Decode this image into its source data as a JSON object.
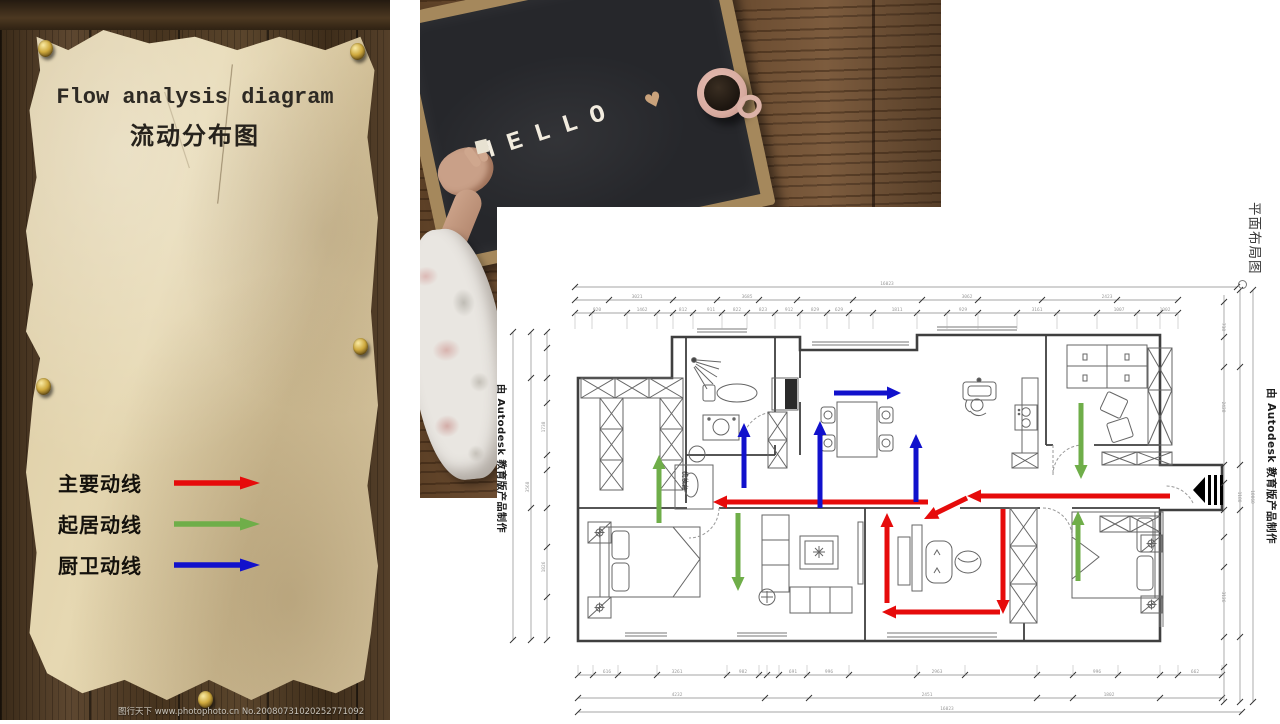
{
  "left_panel": {
    "title_en": "Flow analysis diagram",
    "title_zh": "流动分布图",
    "legend": [
      {
        "label": "主要动线",
        "color": "#e60b0b"
      },
      {
        "label": "起居动线",
        "color": "#6fae49"
      },
      {
        "label": "厨卫动线",
        "color": "#1111cc"
      }
    ],
    "watermark": "图行天下 www.photophoto.cn  No.20080731020252771092"
  },
  "photo": {
    "board_word": "HELLO",
    "heart": "♥"
  },
  "floor_plan": {
    "side_label": "平面布局图",
    "cad_watermark": "由 Autodesk 教育版产品制作",
    "vanity_label": "梳妆台",
    "arrow_colors": {
      "main": "#e60b0b",
      "living": "#6fae49",
      "kitchen_bath": "#1111cc"
    },
    "arrows": [
      {
        "type": "main",
        "x1": 673,
        "y1": 289,
        "x2": 470,
        "y2": 289
      },
      {
        "type": "main",
        "x1": 431,
        "y1": 295,
        "x2": 216,
        "y2": 295
      },
      {
        "type": "main",
        "x1": 470,
        "y1": 291,
        "x2": 427,
        "y2": 312
      },
      {
        "type": "main",
        "x1": 390,
        "y1": 396,
        "x2": 390,
        "y2": 306
      },
      {
        "type": "main",
        "x1": 506,
        "y1": 302,
        "x2": 506,
        "y2": 407
      },
      {
        "type": "main",
        "x1": 503,
        "y1": 405,
        "x2": 385,
        "y2": 405
      },
      {
        "type": "living",
        "x1": 162,
        "y1": 316,
        "x2": 162,
        "y2": 248
      },
      {
        "type": "living",
        "x1": 241,
        "y1": 306,
        "x2": 241,
        "y2": 384
      },
      {
        "type": "living",
        "x1": 584,
        "y1": 196,
        "x2": 584,
        "y2": 272
      },
      {
        "type": "living",
        "x1": 581,
        "y1": 374,
        "x2": 581,
        "y2": 304
      },
      {
        "type": "kitchen_bath",
        "x1": 247,
        "y1": 281,
        "x2": 247,
        "y2": 216
      },
      {
        "type": "kitchen_bath",
        "x1": 323,
        "y1": 301,
        "x2": 323,
        "y2": 214
      },
      {
        "type": "kitchen_bath",
        "x1": 337,
        "y1": 186,
        "x2": 404,
        "y2": 186
      },
      {
        "type": "kitchen_bath",
        "x1": 419,
        "y1": 295,
        "x2": 419,
        "y2": 227
      }
    ],
    "dim_labels": {
      "top": [
        {
          "x": 390,
          "y": 78,
          "t": "16023"
        },
        {
          "x": 140,
          "y": 91,
          "t": "3021"
        },
        {
          "x": 250,
          "y": 91,
          "t": "3685"
        },
        {
          "x": 470,
          "y": 91,
          "t": "3062"
        },
        {
          "x": 610,
          "y": 91,
          "t": "2423"
        },
        {
          "x": 100,
          "y": 104,
          "t": "920"
        },
        {
          "x": 145,
          "y": 104,
          "t": "1462"
        },
        {
          "x": 186,
          "y": 104,
          "t": "812"
        },
        {
          "x": 214,
          "y": 104,
          "t": "911"
        },
        {
          "x": 240,
          "y": 104,
          "t": "822"
        },
        {
          "x": 266,
          "y": 104,
          "t": "823"
        },
        {
          "x": 292,
          "y": 104,
          "t": "912"
        },
        {
          "x": 318,
          "y": 104,
          "t": "829"
        },
        {
          "x": 342,
          "y": 104,
          "t": "629"
        },
        {
          "x": 400,
          "y": 104,
          "t": "1811"
        },
        {
          "x": 466,
          "y": 104,
          "t": "929"
        },
        {
          "x": 540,
          "y": 104,
          "t": "3161"
        },
        {
          "x": 622,
          "y": 104,
          "t": "1007"
        },
        {
          "x": 668,
          "y": 104,
          "t": "1002"
        }
      ],
      "bottom": [
        {
          "x": 110,
          "y": 466,
          "t": "616"
        },
        {
          "x": 180,
          "y": 466,
          "t": "3261"
        },
        {
          "x": 246,
          "y": 466,
          "t": "982"
        },
        {
          "x": 296,
          "y": 466,
          "t": "691"
        },
        {
          "x": 332,
          "y": 466,
          "t": "996"
        },
        {
          "x": 440,
          "y": 466,
          "t": "2963"
        },
        {
          "x": 600,
          "y": 466,
          "t": "996"
        },
        {
          "x": 698,
          "y": 466,
          "t": "662"
        },
        {
          "x": 180,
          "y": 489,
          "t": "4232"
        },
        {
          "x": 430,
          "y": 489,
          "t": "2451"
        },
        {
          "x": 612,
          "y": 489,
          "t": "1802"
        },
        {
          "x": 450,
          "y": 503,
          "t": "16023"
        }
      ],
      "left": [
        {
          "x": 48,
          "y": 220,
          "t": "1738",
          "rot": -90
        },
        {
          "x": 48,
          "y": 360,
          "t": "1826",
          "rot": -90
        },
        {
          "x": 32,
          "y": 280,
          "t": "3568",
          "rot": -90
        }
      ],
      "right": [
        {
          "x": 725,
          "y": 120,
          "t": "738",
          "rot": 90
        },
        {
          "x": 725,
          "y": 200,
          "t": "2428",
          "rot": 90
        },
        {
          "x": 725,
          "y": 390,
          "t": "3126",
          "rot": 90
        },
        {
          "x": 741,
          "y": 290,
          "t": "1180",
          "rot": 90
        },
        {
          "x": 754,
          "y": 290,
          "t": "10060",
          "rot": 90
        }
      ]
    }
  }
}
